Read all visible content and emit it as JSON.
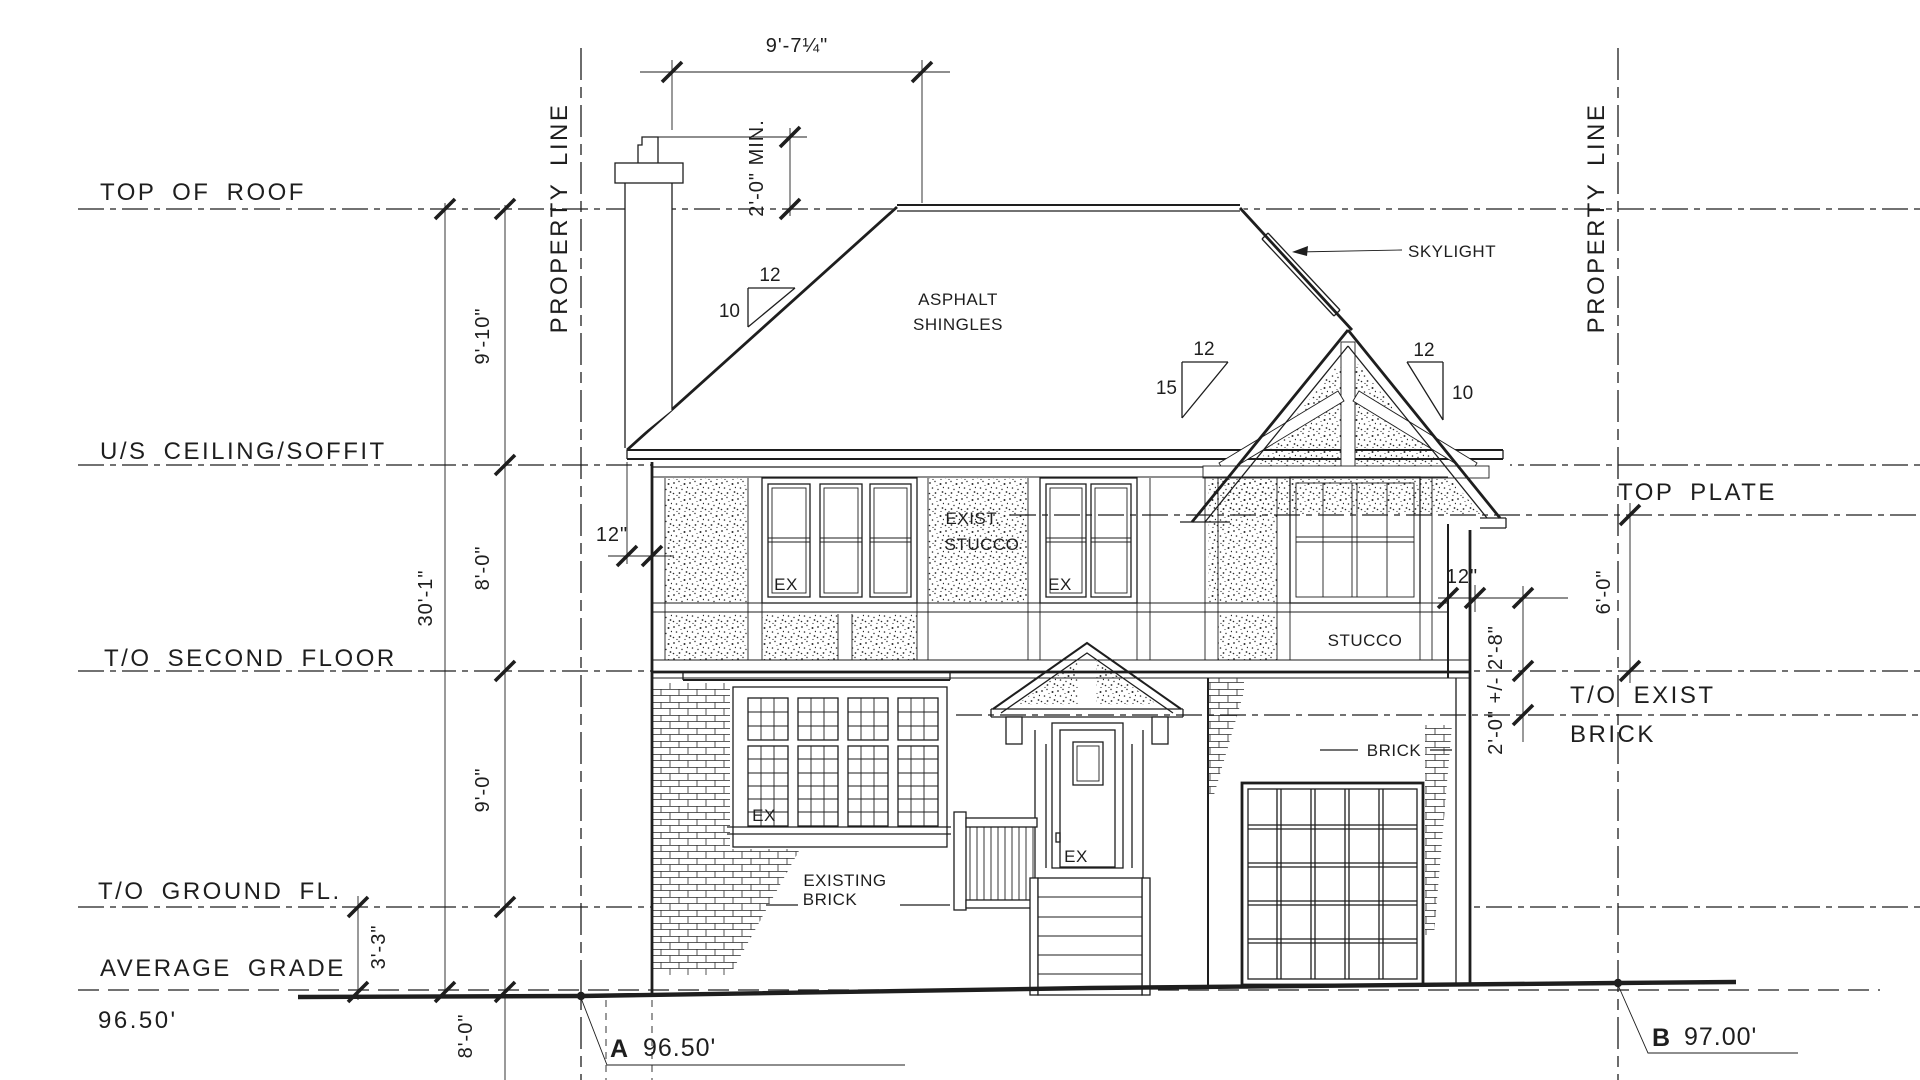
{
  "levels": {
    "top_of_roof": "TOP OF ROOF",
    "us_ceiling_soffit": "U/S CEILING/SOFFIT",
    "to_second_floor": "T/O SECOND FLOOR",
    "to_ground_fl": "T/O GROUND FL.",
    "average_grade": "AVERAGE GRADE",
    "grade_left_elevation": "96.50'",
    "top_plate": "TOP PLATE",
    "to_exist_brick_l1": "T/O EXIST",
    "to_exist_brick_l2": "BRICK"
  },
  "dims": {
    "overall": "30'-1\"",
    "roof_to_ceiling": "9'-10\"",
    "ceiling_to_2nd": "8'-0\"",
    "second_to_ground": "9'-0\"",
    "ground_to_grade": "3'-3\"",
    "below_grade": "8'-0\"",
    "chimney_to_ridge": "9'-7¼\"",
    "chimney_min_height": "2'-0\" MIN.",
    "eave_overhang": "12\"",
    "gable_overhang": "12\"",
    "plate_to_floor": "6'-0\"",
    "floor_to_brick": "2'-0\" +/- 2'-8\""
  },
  "site": {
    "property_line": "PROPERTY LINE",
    "point_a": {
      "tag": "A",
      "elevation": "96.50'"
    },
    "point_b": {
      "tag": "B",
      "elevation": "97.00'"
    }
  },
  "materials": {
    "roof_l1": "ASPHALT",
    "roof_l2": "SHINGLES",
    "skylight": "SKYLIGHT",
    "exist_stucco_l1": "EXIST.",
    "exist_stucco_l2": "STUCCO",
    "stucco": "STUCCO",
    "brick": "BRICK",
    "existing_brick_l1": "EXISTING",
    "existing_brick_l2": "BRICK",
    "existing_window": "EX"
  },
  "slopes": {
    "main_run": "12",
    "main_rise": "10",
    "gable_run": "12",
    "gable_rise": "15",
    "hip_run": "12",
    "hip_rise": "10"
  },
  "colors": {
    "ink": "#1e1e1e",
    "paper": "#ffffff"
  }
}
